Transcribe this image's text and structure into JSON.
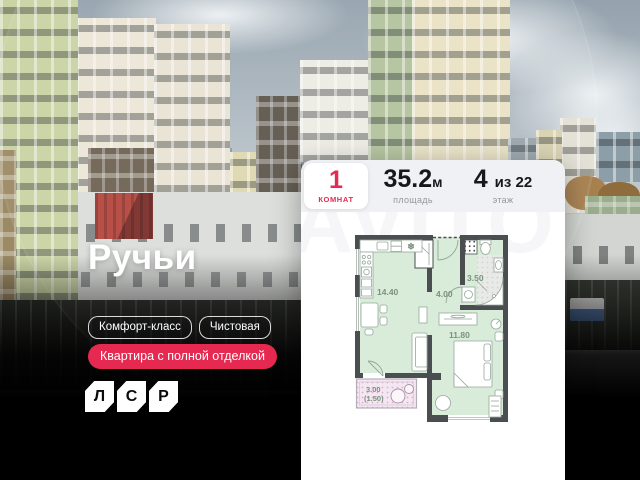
{
  "overlay": {
    "title": "Ручьи",
    "badges": [
      {
        "label": "Комфорт-класс"
      },
      {
        "label": "Чистовая"
      }
    ],
    "highlight_badge": {
      "label": "Квартира с полной отделкой"
    },
    "logo": {
      "letters": [
        "Л",
        "С",
        "Р"
      ]
    }
  },
  "card": {
    "watermark": "AVITO",
    "stats": {
      "rooms": {
        "value": "1",
        "label": "комнат"
      },
      "area": {
        "value": "35.2",
        "unit": "м",
        "label": "площадь"
      },
      "floor": {
        "value": "4",
        "suffix": "из 22",
        "label": "этаж"
      }
    }
  },
  "floorplan": {
    "rooms": [
      {
        "name": "kitchen-living",
        "area": "14.40"
      },
      {
        "name": "hallway",
        "area": "4.00"
      },
      {
        "name": "bathroom",
        "area": "3.50"
      },
      {
        "name": "bedroom",
        "area": "11.80"
      },
      {
        "name": "balcony",
        "area": "3.00",
        "area_secondary": "(1.50)"
      }
    ],
    "icons": [
      {
        "name": "snowflake-icon",
        "glyph": "❄"
      }
    ]
  },
  "colors": {
    "accent_red": "#e62950",
    "plan_wall": "#4a4e50",
    "plan_room_fill": "#d9ecda",
    "plan_balcony_fill": "#f4e7f2",
    "plan_label": "#7b917e",
    "card_bg": "#ffffff",
    "stats_bg": "#f0f1f4"
  }
}
